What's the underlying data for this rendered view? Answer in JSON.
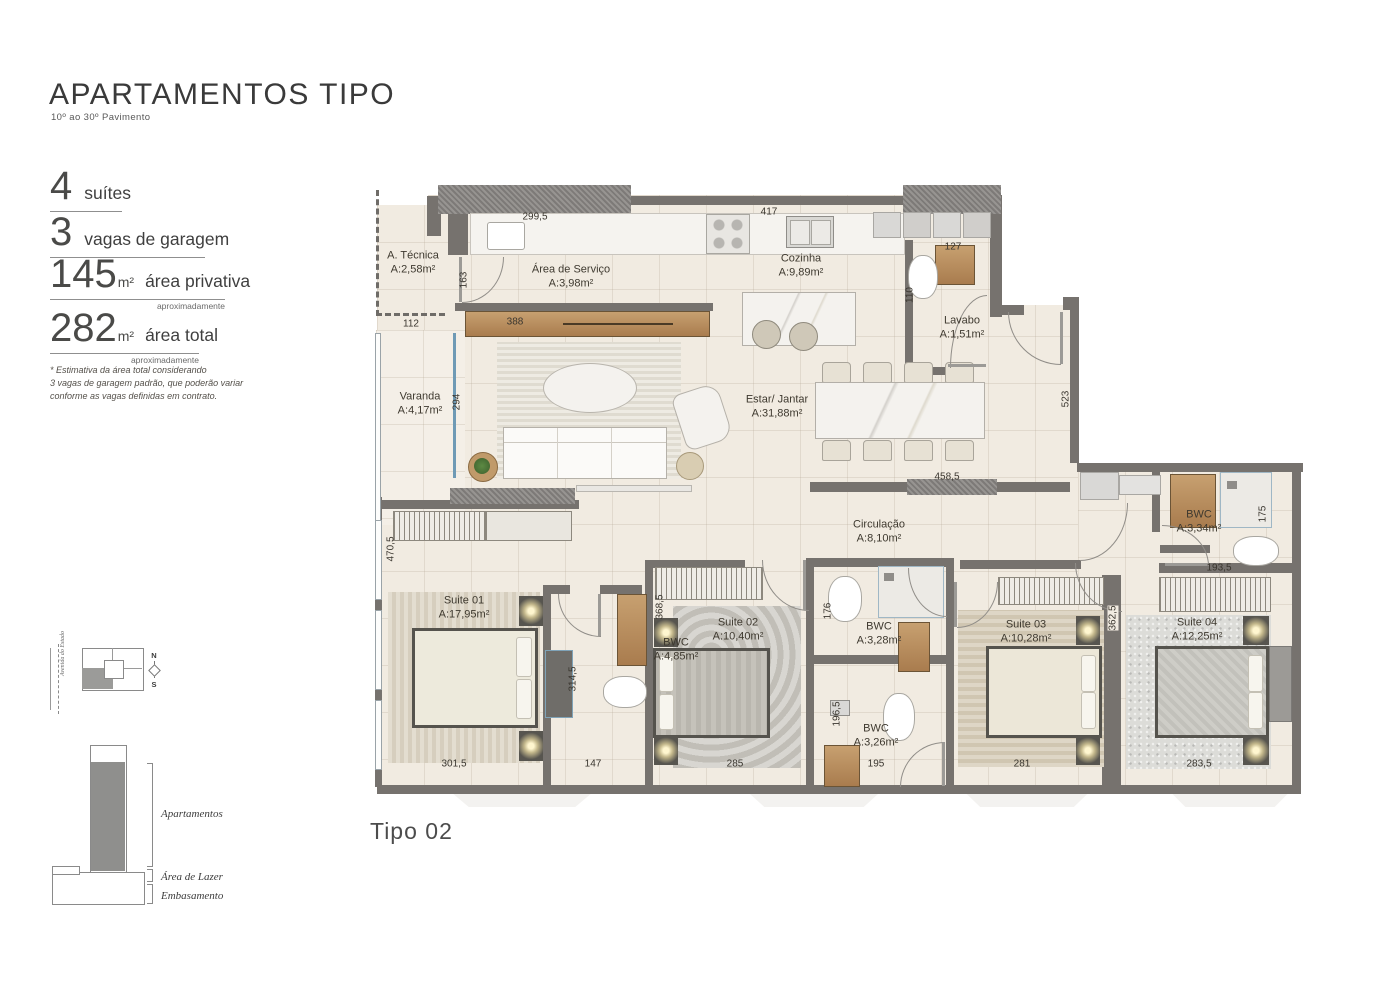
{
  "header": {
    "title": "APARTAMENTOS TIPO",
    "subtitle": "10º ao 30º Pavimento"
  },
  "specs": [
    {
      "value": "4",
      "unit": "",
      "label": "suítes",
      "note": ""
    },
    {
      "value": "3",
      "unit": "",
      "label": "vagas de garagem",
      "note": ""
    },
    {
      "value": "145",
      "unit": "m²",
      "label": "área privativa",
      "note": "aproximadamente"
    },
    {
      "value": "282",
      "unit": "m²",
      "label": "área total",
      "note": "aproximadamente"
    }
  ],
  "disclaimer": "* Estimativa da área total considerando\n3 vagas de garagem padrão, que poderão variar\nconforme as vagas definidas em contrato.",
  "key_plan": {
    "street_label": "Avenida do Estado",
    "compass_north": "N",
    "compass_south": "S"
  },
  "building_section": {
    "labels": [
      "Apartamentos",
      "Área de Lazer",
      "Embasamento"
    ]
  },
  "plan": {
    "name": "Tipo 02",
    "rooms": [
      {
        "name": "A. Técnica",
        "area": "A:2,58m²"
      },
      {
        "name": "Área de Serviço",
        "area": "A:3,98m²"
      },
      {
        "name": "Cozinha",
        "area": "A:9,89m²"
      },
      {
        "name": "Lavabo",
        "area": "A:1,51m²"
      },
      {
        "name": "Varanda",
        "area": "A:4,17m²"
      },
      {
        "name": "Estar/ Jantar",
        "area": "A:31,88m²"
      },
      {
        "name": "Circulação",
        "area": "A:8,10m²"
      },
      {
        "name": "Suite 01",
        "area": "A:17,95m²"
      },
      {
        "name": "BWC",
        "area": "A:4,85m²"
      },
      {
        "name": "Suite 02",
        "area": "A:10,40m²"
      },
      {
        "name": "BWC",
        "area": "A:3,28m²"
      },
      {
        "name": "BWC",
        "area": "A:3,26m²"
      },
      {
        "name": "Suite 03",
        "area": "A:10,28m²"
      },
      {
        "name": "Suite 04",
        "area": "A:12,25m²"
      },
      {
        "name": "BWC",
        "area": "A:3,34m²"
      }
    ],
    "dimensions": [
      "299,5",
      "417",
      "127",
      "163",
      "110",
      "112",
      "388",
      "294",
      "523",
      "458,5",
      "175",
      "193,5",
      "470,5",
      "368,5",
      "176",
      "362,5",
      "314,5",
      "196,5",
      "301,5",
      "147",
      "285",
      "195",
      "281",
      "283,5"
    ]
  },
  "colors": {
    "wall": "#76726e",
    "wall_texture": "#8b8885",
    "floor": "#f1ebe1",
    "glass_accent": "#6f9ab5"
  }
}
